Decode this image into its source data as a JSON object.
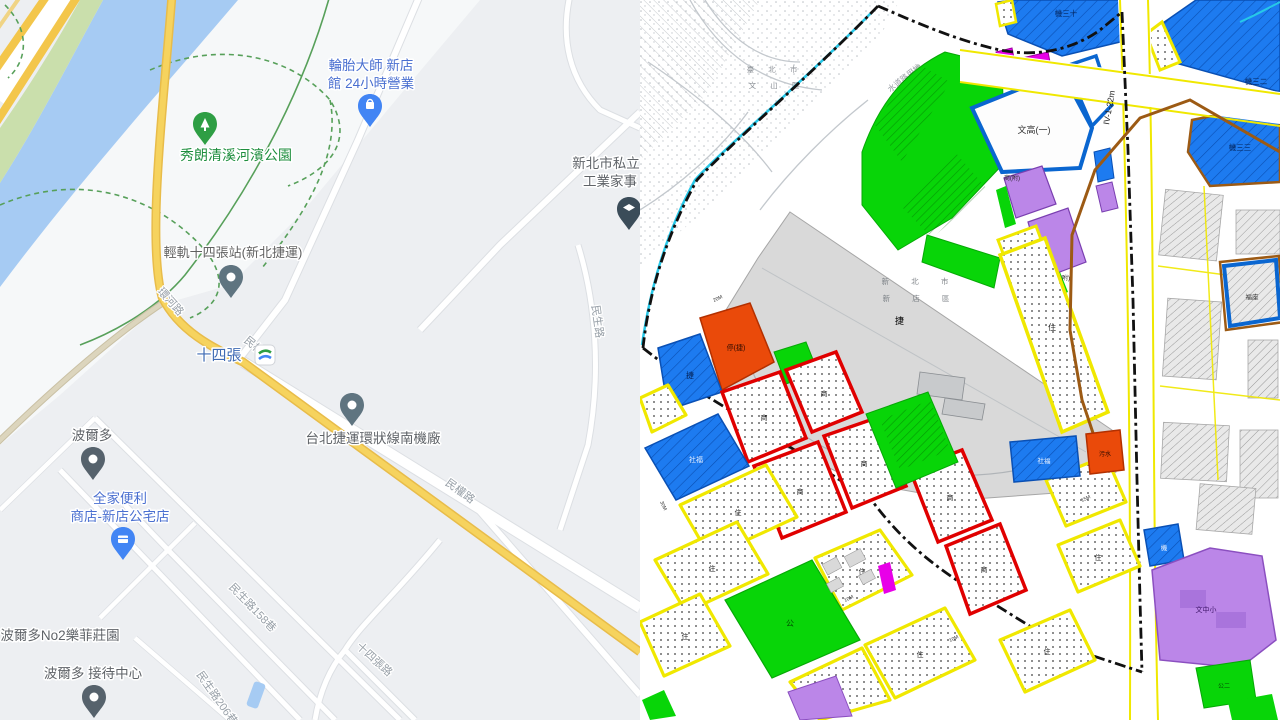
{
  "left_map": {
    "kind": "google-map-panel",
    "pois": {
      "tire_line1": "輪胎大師 新店",
      "tire_line2": "館 24小時營業",
      "park": "秀朗清溪河濱公園",
      "school_line1": "新北市私立",
      "school_line2": "工業家事",
      "lrt_station": "輕軌十四張站(新北捷運)",
      "station": "十四張",
      "depot": "台北捷運環狀線南機廠",
      "bordeaux": "波爾多",
      "family_line1": "全家便利",
      "family_line2": "商店-新店公宅店",
      "bordeaux_no2": "波爾多No2樂菲莊園",
      "reception": "波爾多 接待中心"
    },
    "roads": {
      "huanhe": "環河路",
      "minquan_a": "民權路",
      "minquan_b": "民權路",
      "minsheng": "民生路",
      "minsheng158": "民生路158巷",
      "minsheng206": "民生路206巷",
      "shisizhang_rd": "十四張路"
    },
    "colors": {
      "water": "#a6cbf3",
      "road_yellow": "#f6d35e",
      "park_green_text": "#1e8e3e",
      "poi_blue_text": "#4a6fd0",
      "pin_blue": "#4285f4",
      "pin_gray": "#5f7480",
      "pin_green": "#2e9e44"
    }
  },
  "right_map": {
    "kind": "zoning-map-panel",
    "admin": {
      "taipei_l1": "臺 北 市",
      "taipei_l2": "文 山 區",
      "xinbei_l1": "新 北 市",
      "xinbei_l2": "新 店 區"
    },
    "zones": {
      "ji30": "機三十",
      "ji32": "機三二",
      "ji33": "機三三",
      "wengao1": "文高(一)",
      "wengao2": "文高(二)",
      "shangfu": "商(附)",
      "guangting": "廣停",
      "guang": "廣",
      "tingjie": "停(捷)",
      "jie": "捷",
      "shefu": "社福",
      "wushui": "污水",
      "fuzuo": "福座",
      "ji": "機",
      "wenzhongxiao": "文中小",
      "gong": "公",
      "gong2": "公二",
      "zhu": "住",
      "shang": "商"
    },
    "road_labels": {
      "iv122": "IV-1-22m",
      "waterway": "水道路用地",
      "m10": "10M",
      "m15": "15M",
      "m20": "20M",
      "m30": "30M"
    },
    "colors": {
      "zone_blue": "#1d7bf0",
      "zone_green": "#08d508",
      "zone_yellow_border": "#f0e800",
      "zone_red_border": "#e00000",
      "zone_orange": "#ea4a0a",
      "zone_purple": "#bb86e8",
      "zone_magenta": "#e800e8",
      "boundary_cyan": "#27c8e8",
      "line_brown": "#9c5a14"
    }
  }
}
